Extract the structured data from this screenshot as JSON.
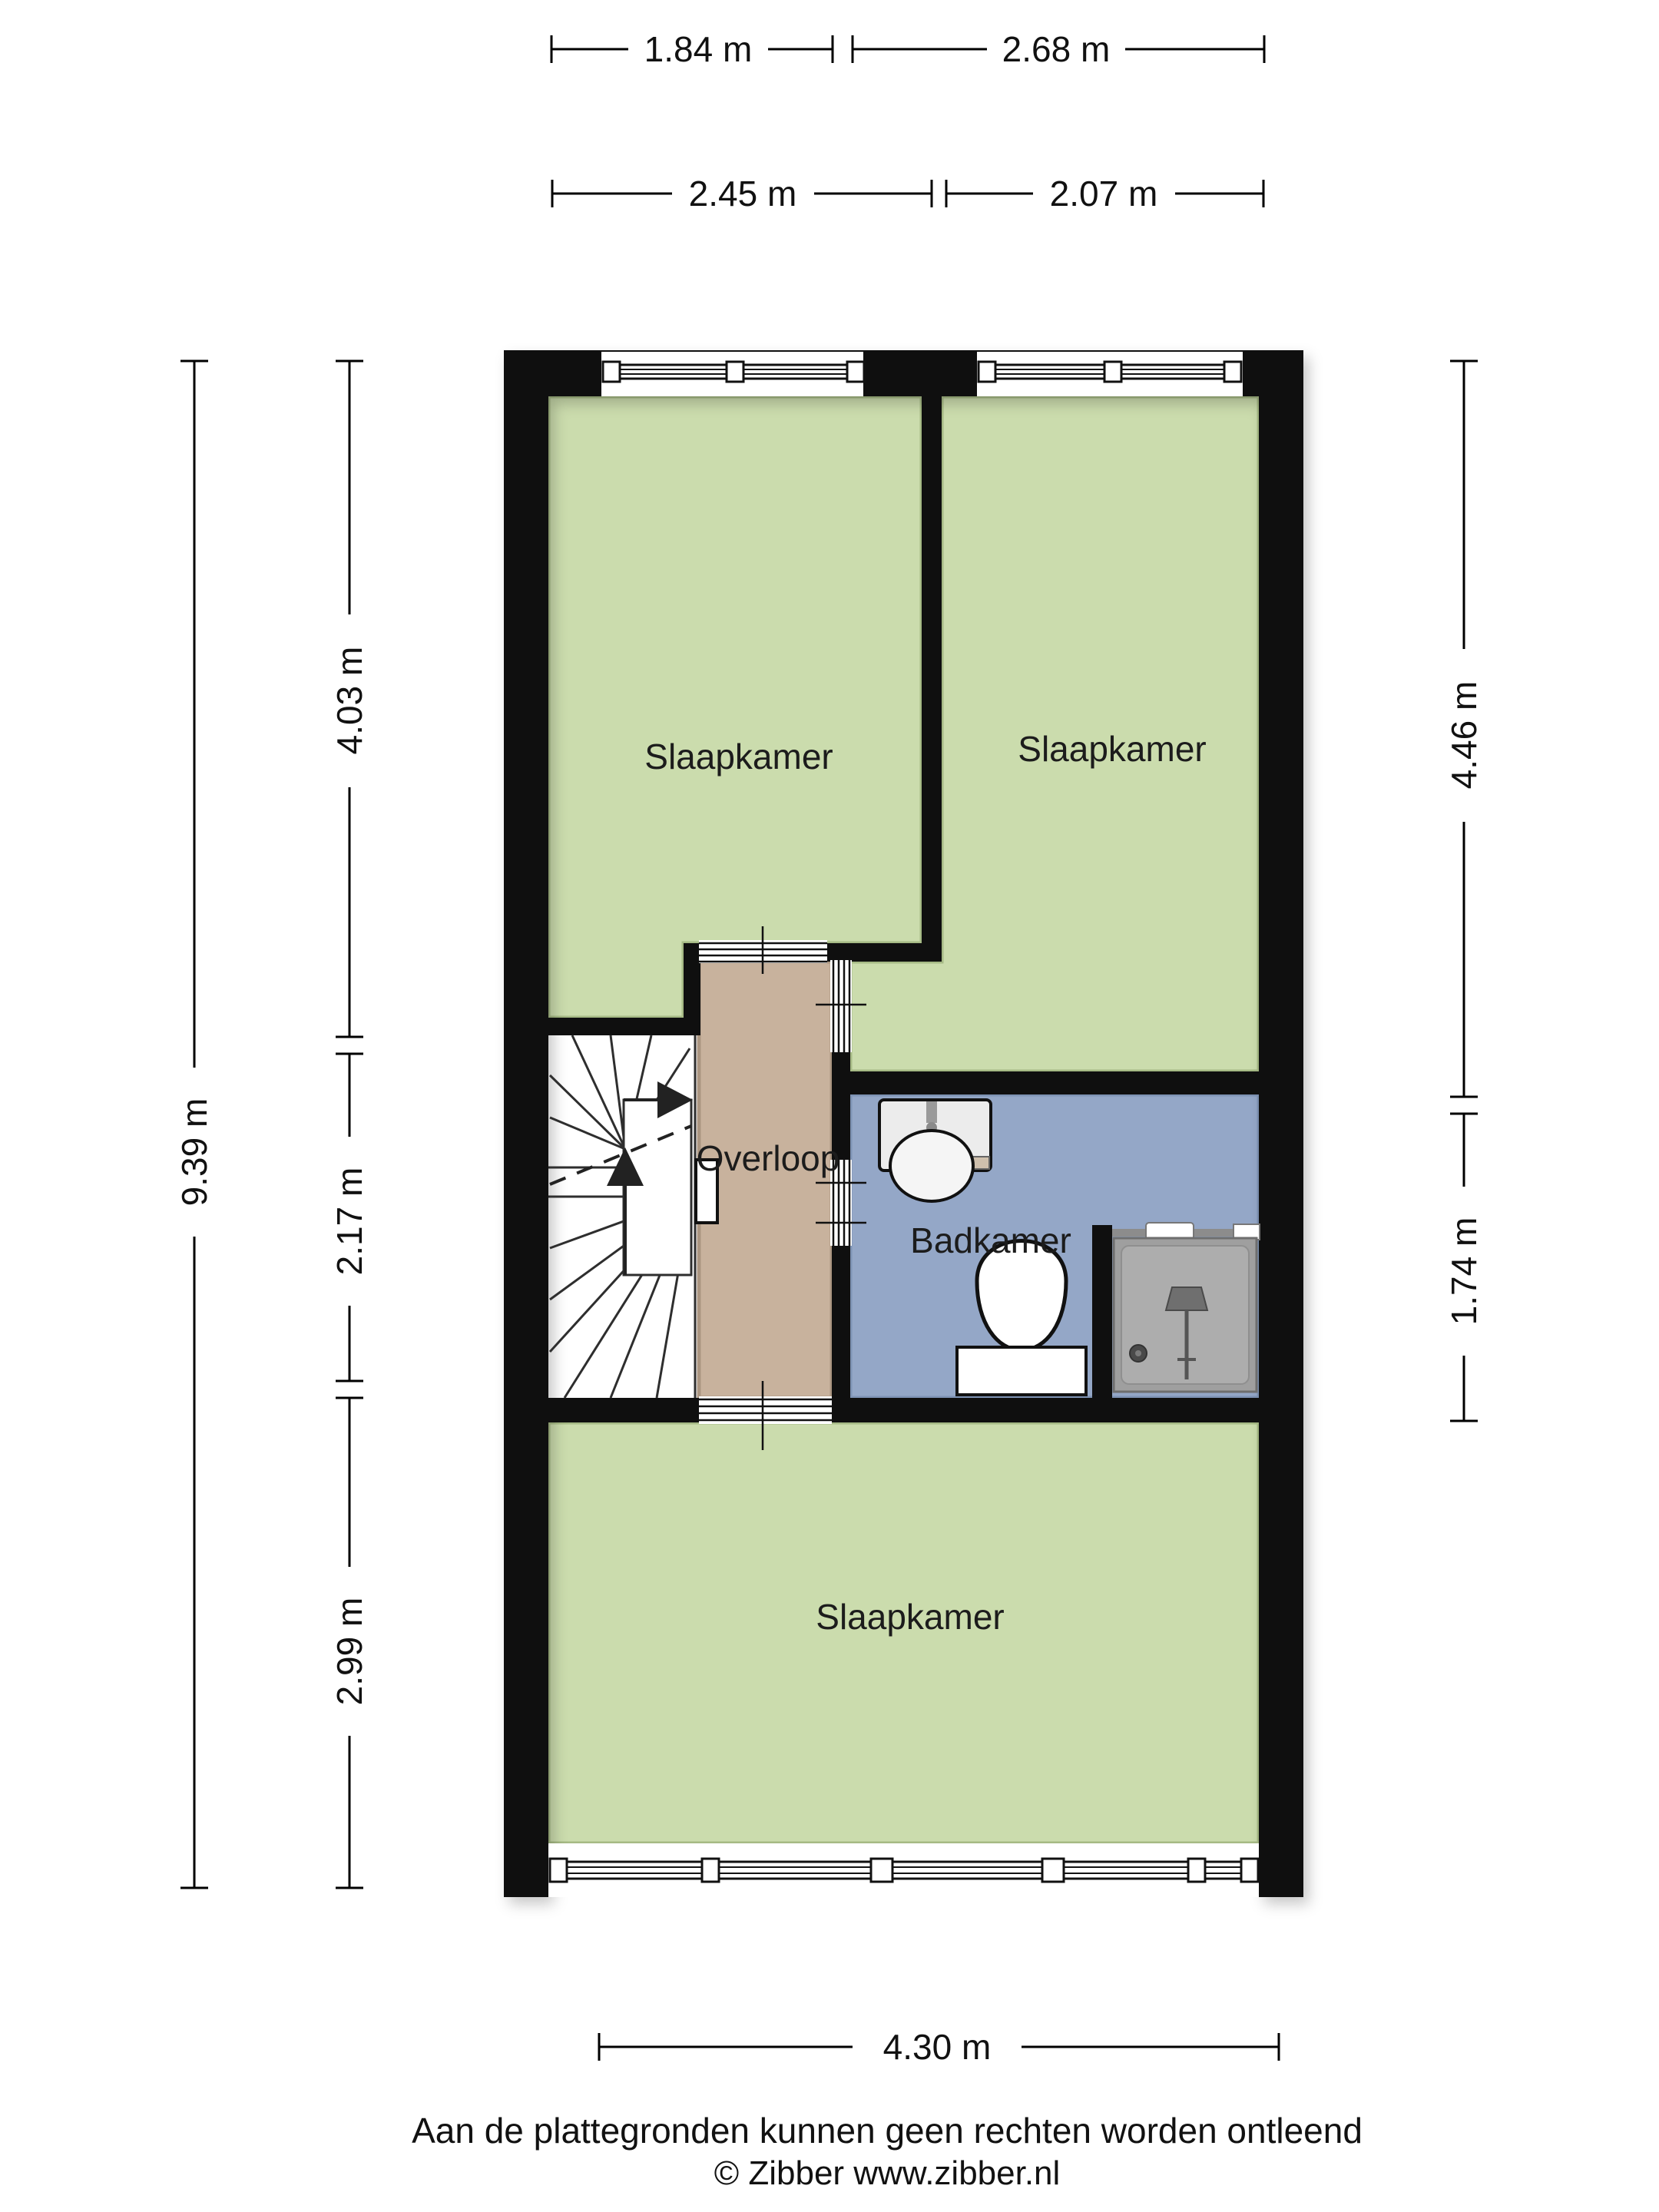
{
  "rooms": [
    {
      "key": "slaapkamer-top-left",
      "name": "Slaapkamer",
      "color": "#cbdcad",
      "edge": "#a6ba85"
    },
    {
      "key": "slaapkamer-top-right",
      "name": "Slaapkamer",
      "color": "#cbdcad",
      "edge": "#a6ba85"
    },
    {
      "key": "overloop",
      "name": "Overloop",
      "color": "#c8b29d",
      "edge": "#ab9681"
    },
    {
      "key": "badkamer",
      "name": "Badkamer",
      "color": "#94a7c7",
      "edge": "#7e93b4"
    },
    {
      "key": "slaapkamer-bottom",
      "name": "Slaapkamer",
      "color": "#cbdcad",
      "edge": "#a6ba85"
    }
  ],
  "dimensions": {
    "top_row1_left": {
      "label": "1.84 m",
      "value_m": 1.84
    },
    "top_row1_right": {
      "label": "2.68 m",
      "value_m": 2.68
    },
    "top_row2_left": {
      "label": "2.45 m",
      "value_m": 2.45
    },
    "top_row2_right": {
      "label": "2.07 m",
      "value_m": 2.07
    },
    "left_total": {
      "label": "9.39 m",
      "value_m": 9.39
    },
    "left_seg1": {
      "label": "4.03 m",
      "value_m": 4.03
    },
    "left_seg2": {
      "label": "2.17 m",
      "value_m": 2.17
    },
    "left_seg3": {
      "label": "2.99 m",
      "value_m": 2.99
    },
    "right_seg1": {
      "label": "4.46 m",
      "value_m": 4.46
    },
    "right_seg2": {
      "label": "1.74 m",
      "value_m": 1.74
    },
    "bottom": {
      "label": "4.30 m",
      "value_m": 4.3
    }
  },
  "fixtures": [
    {
      "name": "stairs-icon"
    },
    {
      "name": "sink-icon"
    },
    {
      "name": "toilet-icon"
    },
    {
      "name": "shower-icon"
    },
    {
      "name": "window-icon"
    },
    {
      "name": "door-opening-icon"
    }
  ],
  "footer": {
    "disclaimer": "Aan de plattegronden kunnen geen rechten worden ontleend",
    "copyright": "© Zibber www.zibber.nl"
  },
  "colors": {
    "background": "#ffffff",
    "wall": "#0f0f0f",
    "room_green": "#cbdcad",
    "room_green_edge": "#a6ba85",
    "overloop_tan": "#c8b29d",
    "overloop_tan_edge": "#ab9681",
    "badkamer_blue": "#94a7c7",
    "badkamer_blue_edge": "#7e93b4",
    "shower_gray": "#9f9f9f"
  }
}
